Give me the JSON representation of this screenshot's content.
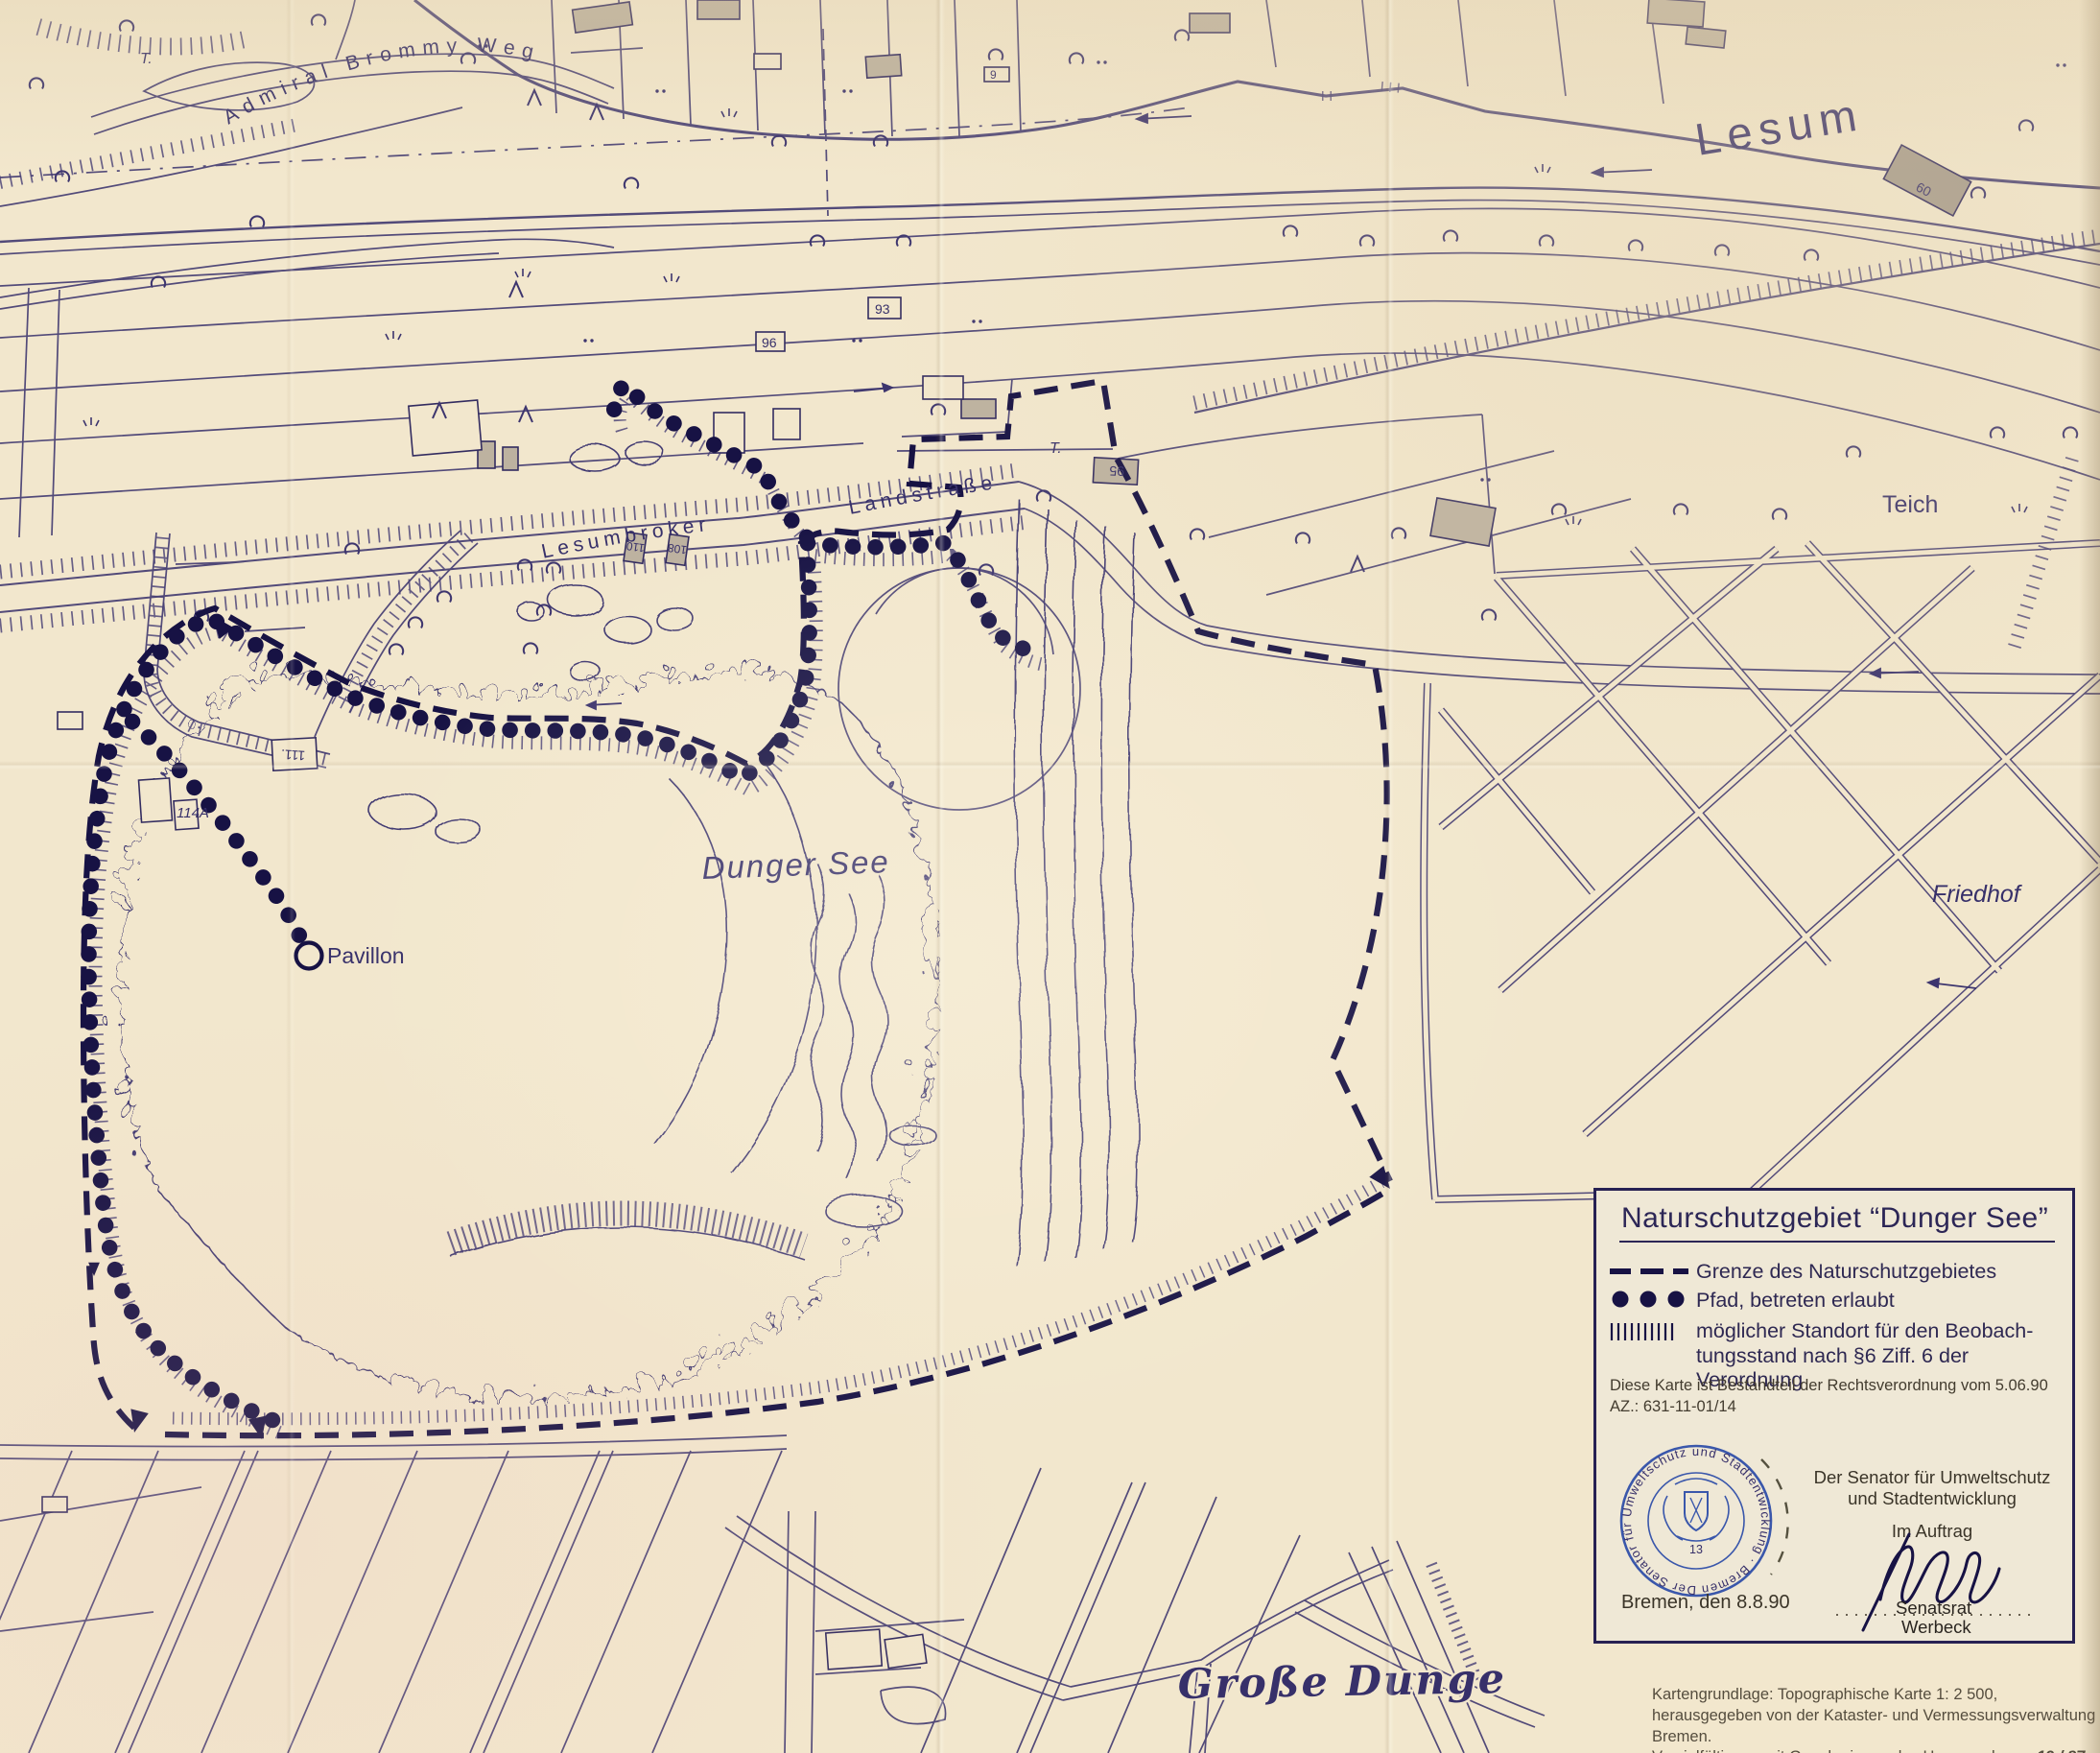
{
  "sheet": {
    "map_labels": {
      "river": "Lesum",
      "lake": "Dunger See",
      "pond": "Teich",
      "cemetery": "Friedhof",
      "south_area": "Große Dunge",
      "pavilion": "Pavillon",
      "street_north": "Admiral Brommy Weg",
      "street_main_left": "Lesumbroker",
      "street_main_right": "Landstraße",
      "t_mark_1": "T.",
      "t_mark_2": "T."
    },
    "house_numbers": {
      "n9": "9",
      "n60": "60",
      "n93": "93",
      "n95": "95",
      "n96": "96",
      "n108": "108",
      "n110": "110",
      "n111": "111.",
      "n114a": "114A"
    }
  },
  "legend": {
    "title": "Naturschutzgebiet “Dunger See”",
    "items": [
      {
        "symbol": "bold-dashed-line",
        "label": "Grenze des Naturschutzgebietes"
      },
      {
        "symbol": "three-dots",
        "label": "Pfad, betreten erlaubt"
      },
      {
        "symbol": "vertical-hatch",
        "label_line1": "möglicher Standort für den Beobach-",
        "label_line2": "tungsstand nach §6 Ziff. 6 der Verordnung"
      }
    ],
    "note_line1": "Diese Karte ist Bestandteil der Rechtsverordnung vom 5.06.90",
    "note_line2": "AZ.: 631-11-01/14",
    "issuer_line1": "Der Senator für Umweltschutz",
    "issuer_line2": "und Stadtentwicklung",
    "commission": "Im Auftrag",
    "signer_title": "Senatsrat",
    "signer_name": "Werbeck",
    "place_date": "Bremen, den 8.8.90",
    "stamp": {
      "ring_text": "Der Senator für Umweltschutz und Stadtentwicklung · Bremen ·",
      "number": "13",
      "color": "#3a57ab"
    }
  },
  "footer": {
    "line1": "Kartengrundlage: Topographische Karte 1: 2 500,",
    "line2": "herausgegeben von der Kataster- und Vermessungsverwaltung Bremen.",
    "line3_prefix": "Vervielfältigung mit Genehmigung des Herausgebers - ",
    "line3_ref": "19 / 87"
  },
  "colors": {
    "paper": "#f2e7cd",
    "ink": "#3d356e",
    "ink_bold": "#171244",
    "building_fill": "#bdb2a0",
    "stamp_blue": "#3a57ab"
  }
}
